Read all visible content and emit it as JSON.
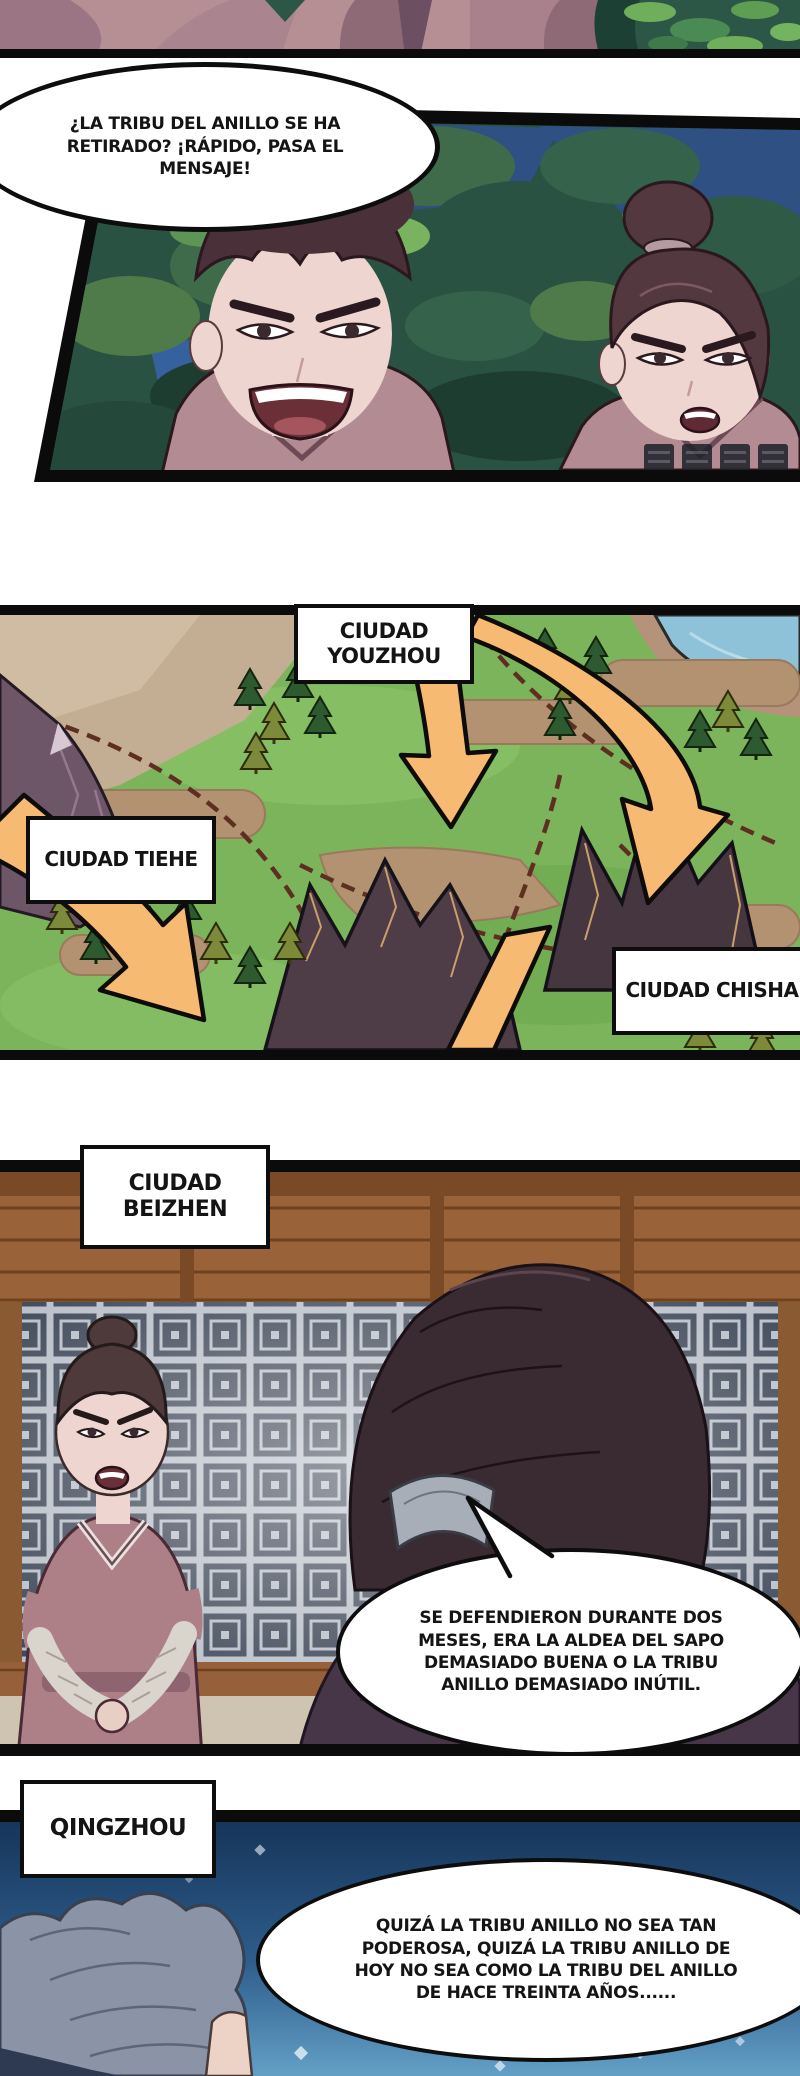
{
  "page": {
    "width": 800,
    "height": 2076,
    "background": "#ffffff",
    "kind": "comic page (Spanish translated manhua)"
  },
  "panel2": {
    "speech_bubble": {
      "lines": [
        "¿LA TRIBU DEL ANILLO SE HA",
        "RETIRADO? ¡RÁPIDO, PASA EL",
        "MENSAJE!"
      ]
    }
  },
  "map": {
    "labels": {
      "youzhou": {
        "lines": [
          "CIUDAD",
          "YOUZHOU"
        ]
      },
      "tiehe": {
        "text": "CIUDAD TIEHE"
      },
      "chisha": {
        "text": "CIUDAD CHISHA"
      }
    }
  },
  "panel4": {
    "label": {
      "lines": [
        "CIUDAD",
        "BEIZHEN"
      ]
    },
    "speech_bubble": {
      "lines": [
        "SE DEFENDIERON DURANTE DOS",
        "MESES, ERA LA ALDEA DEL SAPO",
        "DEMASIADO BUENA O LA TRIBU",
        "ANILLO DEMASIADO INÚTIL."
      ]
    }
  },
  "panel5": {
    "label": {
      "text": "QINGZHOU"
    },
    "speech_bubble": {
      "lines": [
        "QUIZÁ LA TRIBU ANILLO NO SEA TAN",
        "PODEROSA, QUIZÁ LA TRIBU ANILLO DE",
        "HOY NO SEA COMO LA TRIBU DEL ANILLO",
        "DE HACE TREINTA AÑOS......"
      ]
    }
  },
  "colors": {
    "panel_border": "#0d0d0d",
    "speech_bubble_bg": "#ffffff",
    "arrow_orange": "#f6ba72",
    "map_grass": "#7cb45c",
    "night_sky": "#2e5082",
    "robe_mauve": "#b28c92",
    "lattice_grey": "#c6cbd5",
    "panel5_night_top": "#16355a",
    "panel5_night_bottom": "#63a0c6"
  }
}
